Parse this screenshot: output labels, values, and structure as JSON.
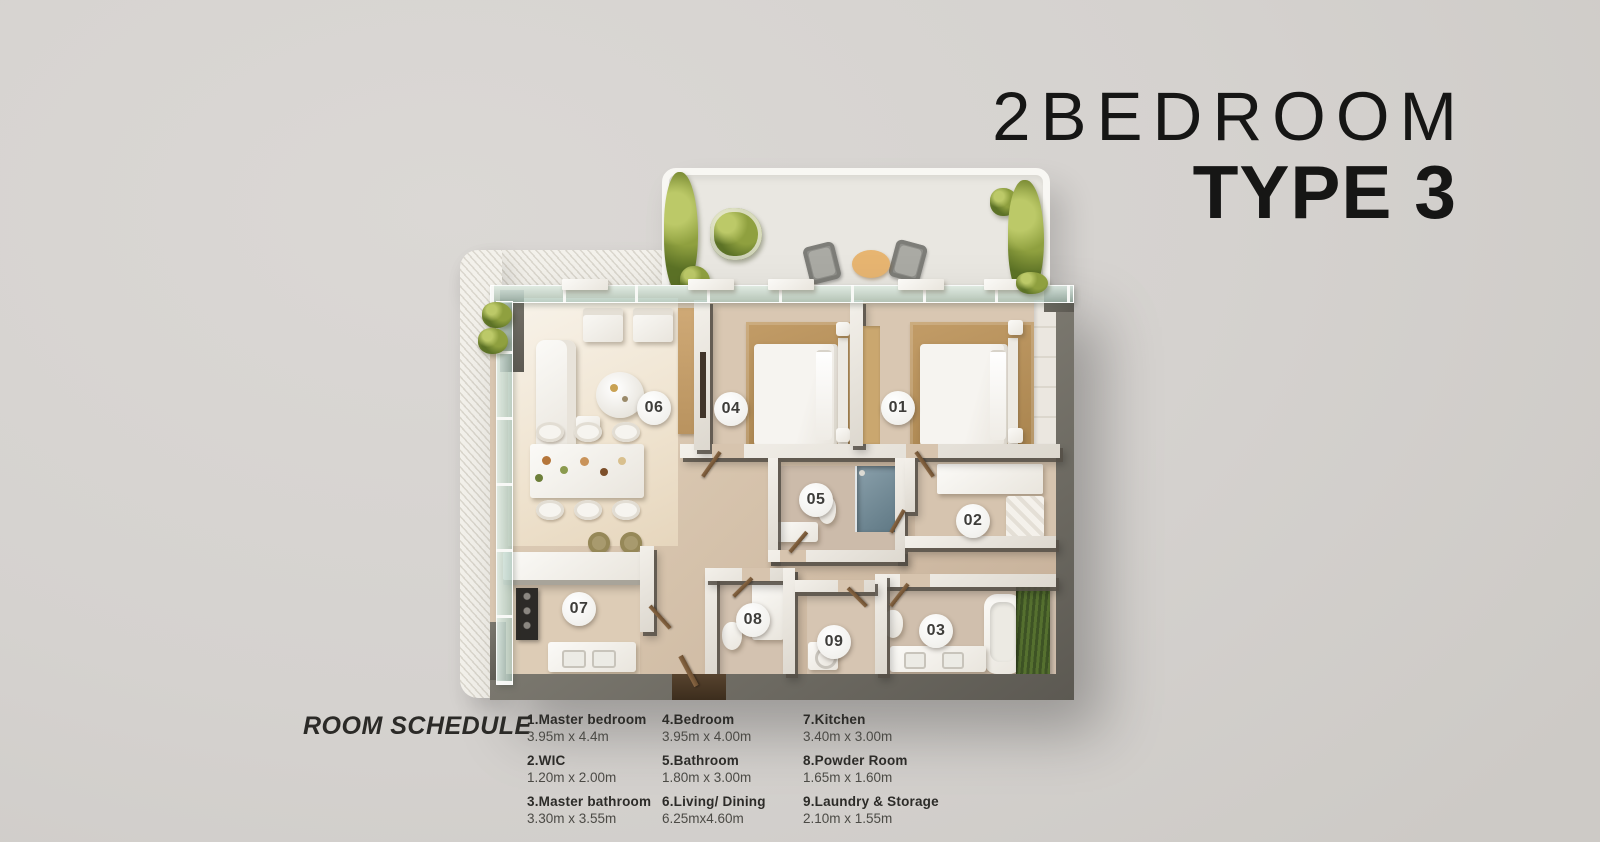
{
  "title": {
    "line1": "2BEDROOM",
    "line2": "TYPE 3"
  },
  "room_schedule": {
    "heading": "ROOM SCHEDULE",
    "columns": [
      {
        "items": [
          {
            "name": "1.Master bedroom",
            "dims": "3.95m x 4.4m"
          },
          {
            "name": "2.WIC",
            "dims": "1.20m x 2.00m"
          },
          {
            "name": "3.Master bathroom",
            "dims": "3.30m x 3.55m"
          }
        ]
      },
      {
        "items": [
          {
            "name": "4.Bedroom",
            "dims": "3.95m x 4.00m"
          },
          {
            "name": "5.Bathroom",
            "dims": "1.80m x 3.00m"
          },
          {
            "name": "6.Living/ Dining",
            "dims": "6.25mx4.60m"
          }
        ]
      },
      {
        "items": [
          {
            "name": "7.Kitchen",
            "dims": "3.40m x 3.00m"
          },
          {
            "name": "8.Powder Room",
            "dims": "1.65m x 1.60m"
          },
          {
            "name": "9.Laundry & Storage",
            "dims": "2.10m x 1.55m"
          }
        ]
      }
    ]
  },
  "floor_plan": {
    "badges": [
      {
        "label": "01"
      },
      {
        "label": "02"
      },
      {
        "label": "03"
      },
      {
        "label": "04"
      },
      {
        "label": "05"
      },
      {
        "label": "06"
      },
      {
        "label": "07"
      },
      {
        "label": "08"
      },
      {
        "label": "09"
      }
    ]
  },
  "colors": {
    "background": "#d5d2cf",
    "title_text": "#161615",
    "wall_dark": "#69665f",
    "partition_light": "#f3f0ea",
    "floor_beige": "#d8c6b1",
    "floor_ivory": "#f5efe4",
    "rug_tan": "#b8925d",
    "glass": "#cfe0d8",
    "plant_green": "#84953c",
    "terrace_floor": "#e9e7e1",
    "badge_bg": "#f4f3f0",
    "badge_text": "#3e3d3a",
    "schedule_text": "#2c2b28"
  }
}
